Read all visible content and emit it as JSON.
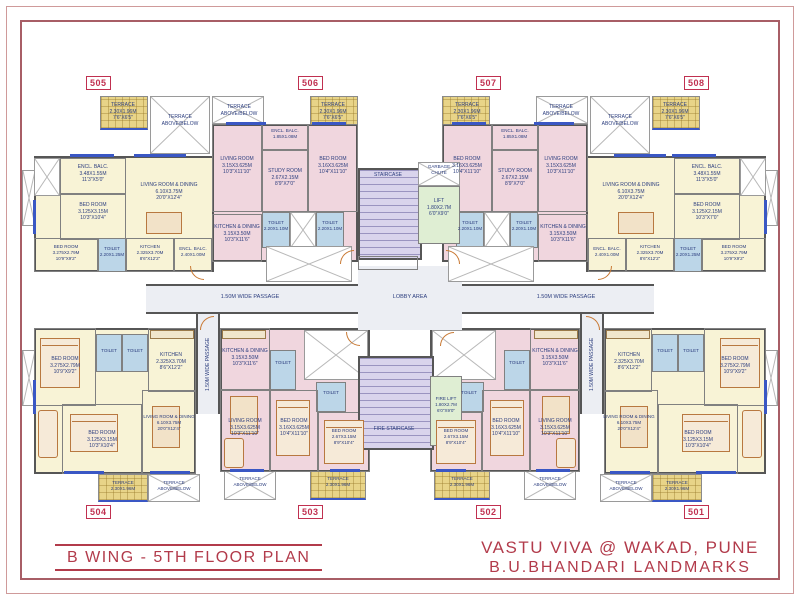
{
  "title_block": {
    "plan_title": "B WING - 5TH FLOOR PLAN",
    "project_name": "VASTU VIVA @ WAKAD, PUNE",
    "developer": "B.U.BHANDARI  LANDMARKS"
  },
  "unit_tags": {
    "top": [
      "505",
      "506",
      "507",
      "508"
    ],
    "bottom": [
      "504",
      "503",
      "502",
      "501"
    ]
  },
  "core": {
    "staircase": "STAIRCASE",
    "garbage_chute": "GARBAGE\nCHUTE",
    "lift": "LIFT\n1.80X2.7M\n6'0\"X9'0\"",
    "lobby": "LOBBY AREA",
    "passage_left": "1.50M WIDE PASSAGE",
    "passage_right": "1.50M WIDE PASSAGE",
    "passage_vert_left": "1.50M WIDE PASSAGE",
    "passage_vert_right": "1.50M WIDE PASSAGE",
    "fire_staircase": "FIRE STAIRCASE",
    "fire_lift": "FIRE LIFT\n1.80X2.7M\n6'0\"X9'0\""
  },
  "colors": {
    "accent_red": "#b23b4b",
    "tag_red": "#c03050",
    "wall_gray": "#565656",
    "room_cream": "#f8f3d6",
    "room_pink": "#f0d6de",
    "stair_lavender": "#d9d4ec",
    "lift_green": "#dfeed3",
    "toilet_blue": "#bcd6e8",
    "terrace_yellow": "#e8d488",
    "window_blue": "#3a57c4",
    "door_orange": "#c97a35",
    "label_navy": "#2b3d7e"
  },
  "units": {
    "u505": {
      "terrace": "TERRACE\n2.30X1.96M\n7'6\"X6'5\"",
      "terrace_open": "TERRACE\nABOVE/BELOW",
      "encl_balc": "ENCL. BALC.\n3.48X1.55M\n11'3\"X5'0\"",
      "bed1": "BED ROOM\n3.125X3.15M\n10'3\"X10'4\"",
      "living": "LIVING ROOM & DINING\n6.10X3.75M\n20'0\"X12'4\"",
      "bed2": "BED ROOM\n3.275X2.79M\n10'9\"X9'2\"",
      "toilet": "TOILET\n2.20X1.25M",
      "kitchen": "KITCHEN\n2.325X3.70M\n8'6\"X12'2\"",
      "encl_balc2": "ENCL. BALC.\n2.40X1.00M"
    },
    "u506": {
      "terrace_open": "TERRACE\nABOVE/BELOW",
      "terrace": "TERRACE\n2.30X1.96M\n7'6\"X6'5\"",
      "encl_balc": "ENCL. BALC.\n1.85X1.08M",
      "living": "LIVING ROOM\n3.15X3.625M\n10'3\"X11'10\"",
      "study": "STUDY ROOM\n2.67X2.15M\n8'9\"X7'0\"",
      "bed": "BED ROOM\n3.16X3.625M\n10'4\"X11'10\"",
      "toilet1": "TOILET\n2.20X1.10M",
      "toilet2": "TOILET\n2.20X1.10M",
      "kitchen": "KITCHEN & DINING\n3.15X3.50M\n10'3\"X11'6\""
    },
    "u507": {
      "terrace": "TERRACE\n2.30X1.96M\n7'6\"X6'5\"",
      "terrace_open": "TERRACE\nABOVE/BELOW",
      "encl_balc": "ENCL. BALC.\n1.85X1.08M",
      "living": "LIVING ROOM\n3.15X3.625M\n10'3\"X11'10\"",
      "study": "STUDY ROOM\n2.67X2.15M\n8'9\"X7'0\"",
      "bed": "BED ROOM\n3.16X3.625M\n10'4\"X11'10\"",
      "toilet1": "TOILET\n2.20X1.10M",
      "toilet2": "TOILET\n2.20X1.10M",
      "kitchen": "KITCHEN & DINING\n3.15X3.50M\n10'3\"X11'6\""
    },
    "u508": {
      "terrace_open": "TERRACE\nABOVE/BELOW",
      "terrace": "TERRACE\n2.30X1.96M\n7'6\"X6'5\"",
      "encl_balc": "ENCL. BALC.\n3.48X1.55M\n11'3\"X5'0\"",
      "bed1": "BED ROOM\n3.125X2.15M\n10'3\"X7'0\"",
      "living": "LIVING ROOM & DINING\n6.10X3.75M\n20'0\"X12'4\"",
      "bed2": "BED ROOM\n3.275X2.79M\n10'9\"X9'2\"",
      "toilet": "TOILET\n2.20X1.25M",
      "kitchen": "KITCHEN\n2.325X3.70M\n8'6\"X12'2\"",
      "encl_balc2": "ENCL. BALC.\n2.40X1.00M"
    },
    "u504": {
      "bed1": "BED ROOM\n3.275X2.79M\n10'9\"X9'2\"",
      "toilet1": "TOILET",
      "toilet2": "TOILET",
      "kitchen": "KITCHEN\n2.325X3.70M\n8'6\"X12'2\"",
      "bed2": "BED ROOM\n3.125X3.15M\n10'3\"X10'4\"",
      "living": "LIVING ROOM & DINING\n6.10X3.75M\n20'0\"X12'4\"",
      "terrace_hatch": "TERRACE\n2.30X1.96M",
      "terrace_open": "TERRACE\nABOVE/BELOW"
    },
    "u503": {
      "kitchen": "KITCHEN & DINING\n3.15X3.50M\n10'3\"X11'6\"",
      "living": "LIVING ROOM\n3.15X3.625M\n10'3\"X11'10\"",
      "toilet1": "TOILET",
      "toilet2": "TOILET",
      "bed1": "BED ROOM\n3.16X3.625M\n10'4\"X11'10\"",
      "bed2": "BED ROOM\n2.67X3.15M\n8'9\"X10'4\"",
      "terrace_open": "TERRACE\nABOVE/BELOW",
      "terrace_hatch": "TERRACE\n2.30X1.96M"
    },
    "u502": {
      "kitchen": "KITCHEN & DINING\n3.15X3.50M\n10'3\"X11'6\"",
      "living": "LIVING ROOM\n3.15X3.625M\n10'3\"X11'10\"",
      "toilet1": "TOILET",
      "toilet2": "TOILET",
      "bed1": "BED ROOM\n3.16X3.625M\n10'4\"X11'10\"",
      "bed2": "BED ROOM\n2.67X3.15M\n8'9\"X10'4\"",
      "terrace_hatch": "TERRACE\n2.30X1.96M",
      "terrace_open": "TERRACE\nABOVE/BELOW"
    },
    "u501": {
      "kitchen": "KITCHEN\n2.325X3.70M\n8'6\"X12'2\"",
      "toilet1": "TOILET",
      "toilet2": "TOILET",
      "bed1": "BED ROOM\n3.275X2.79M\n10'9\"X9'2\"",
      "living": "LIVING ROOM & DINING\n6.10X3.75M\n20'0\"X12'4\"",
      "bed2": "BED ROOM\n3.125X3.15M\n10'3\"X10'4\"",
      "terrace_open": "TERRACE\nABOVE/BELOW",
      "terrace_hatch": "TERRACE\n2.30X1.96M"
    }
  }
}
